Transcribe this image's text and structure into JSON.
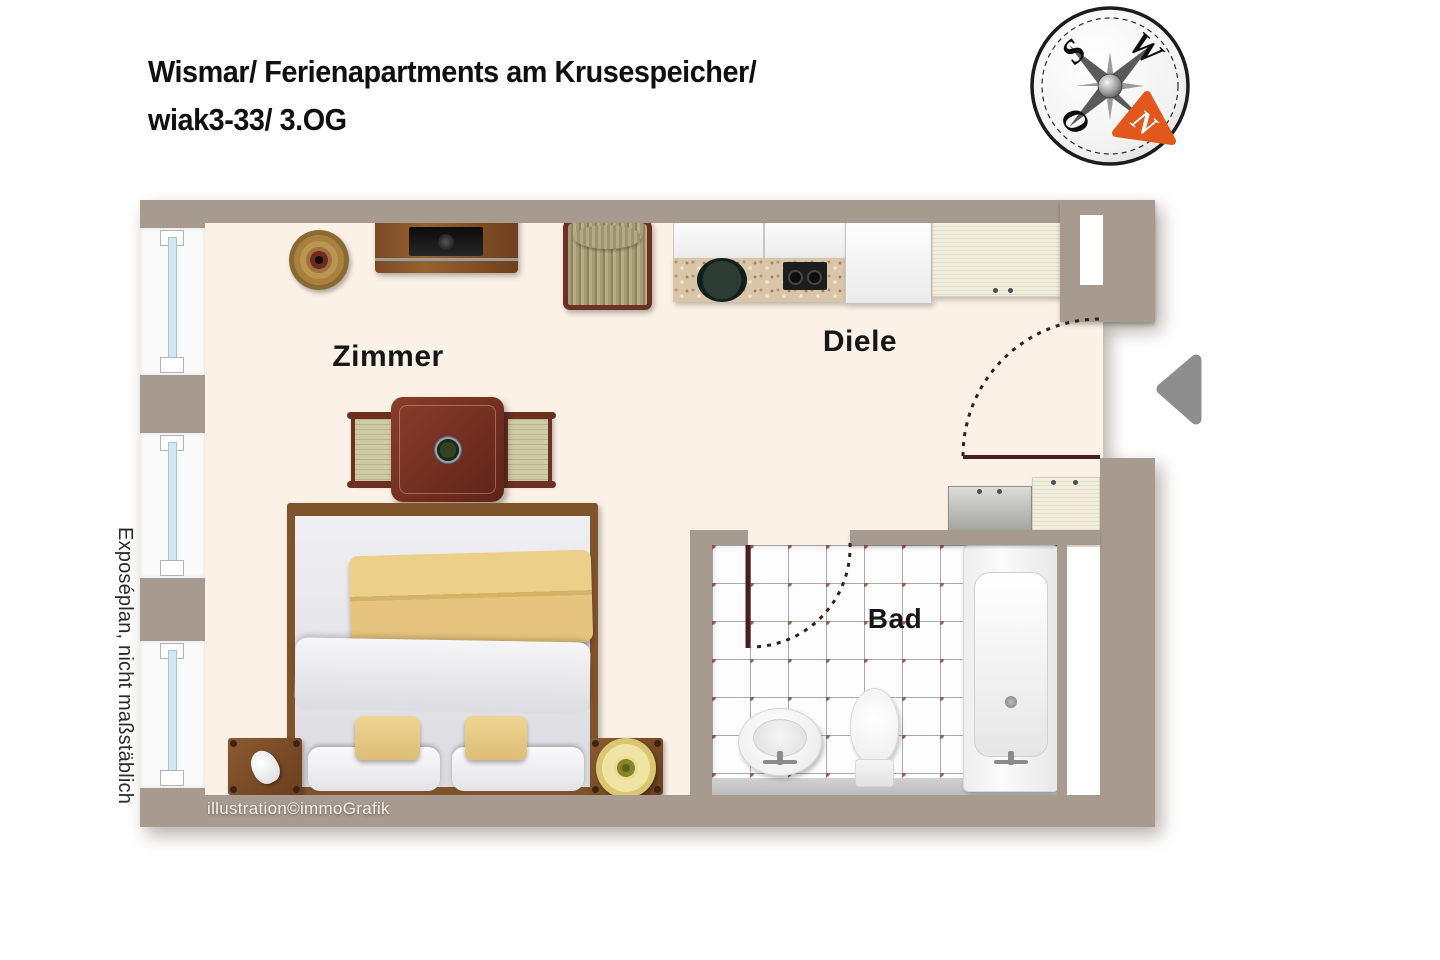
{
  "title": {
    "line1": "Wismar/ Ferienapartments am Krusespeicher/",
    "line2": "wiak3-33/ 3.OG"
  },
  "compass": {
    "s": "S",
    "w": "W",
    "o": "O",
    "n": "N"
  },
  "rooms": {
    "zimmer": "Zimmer",
    "diele": "Diele",
    "bad": "Bad"
  },
  "side_note": "Exposéplan, nicht maßstäblich",
  "copyright": "illustration©immoGrafik",
  "colors": {
    "wall": "#a79b8f",
    "floor": "#fcf1e6",
    "door_leaf": "#4a1d1d",
    "tile_dot": "#9a5f53",
    "compass_north_arrow": "#e2581c",
    "entrance_arrow": "#8e8e8e",
    "blanket_yellow": "#e5c47d"
  }
}
